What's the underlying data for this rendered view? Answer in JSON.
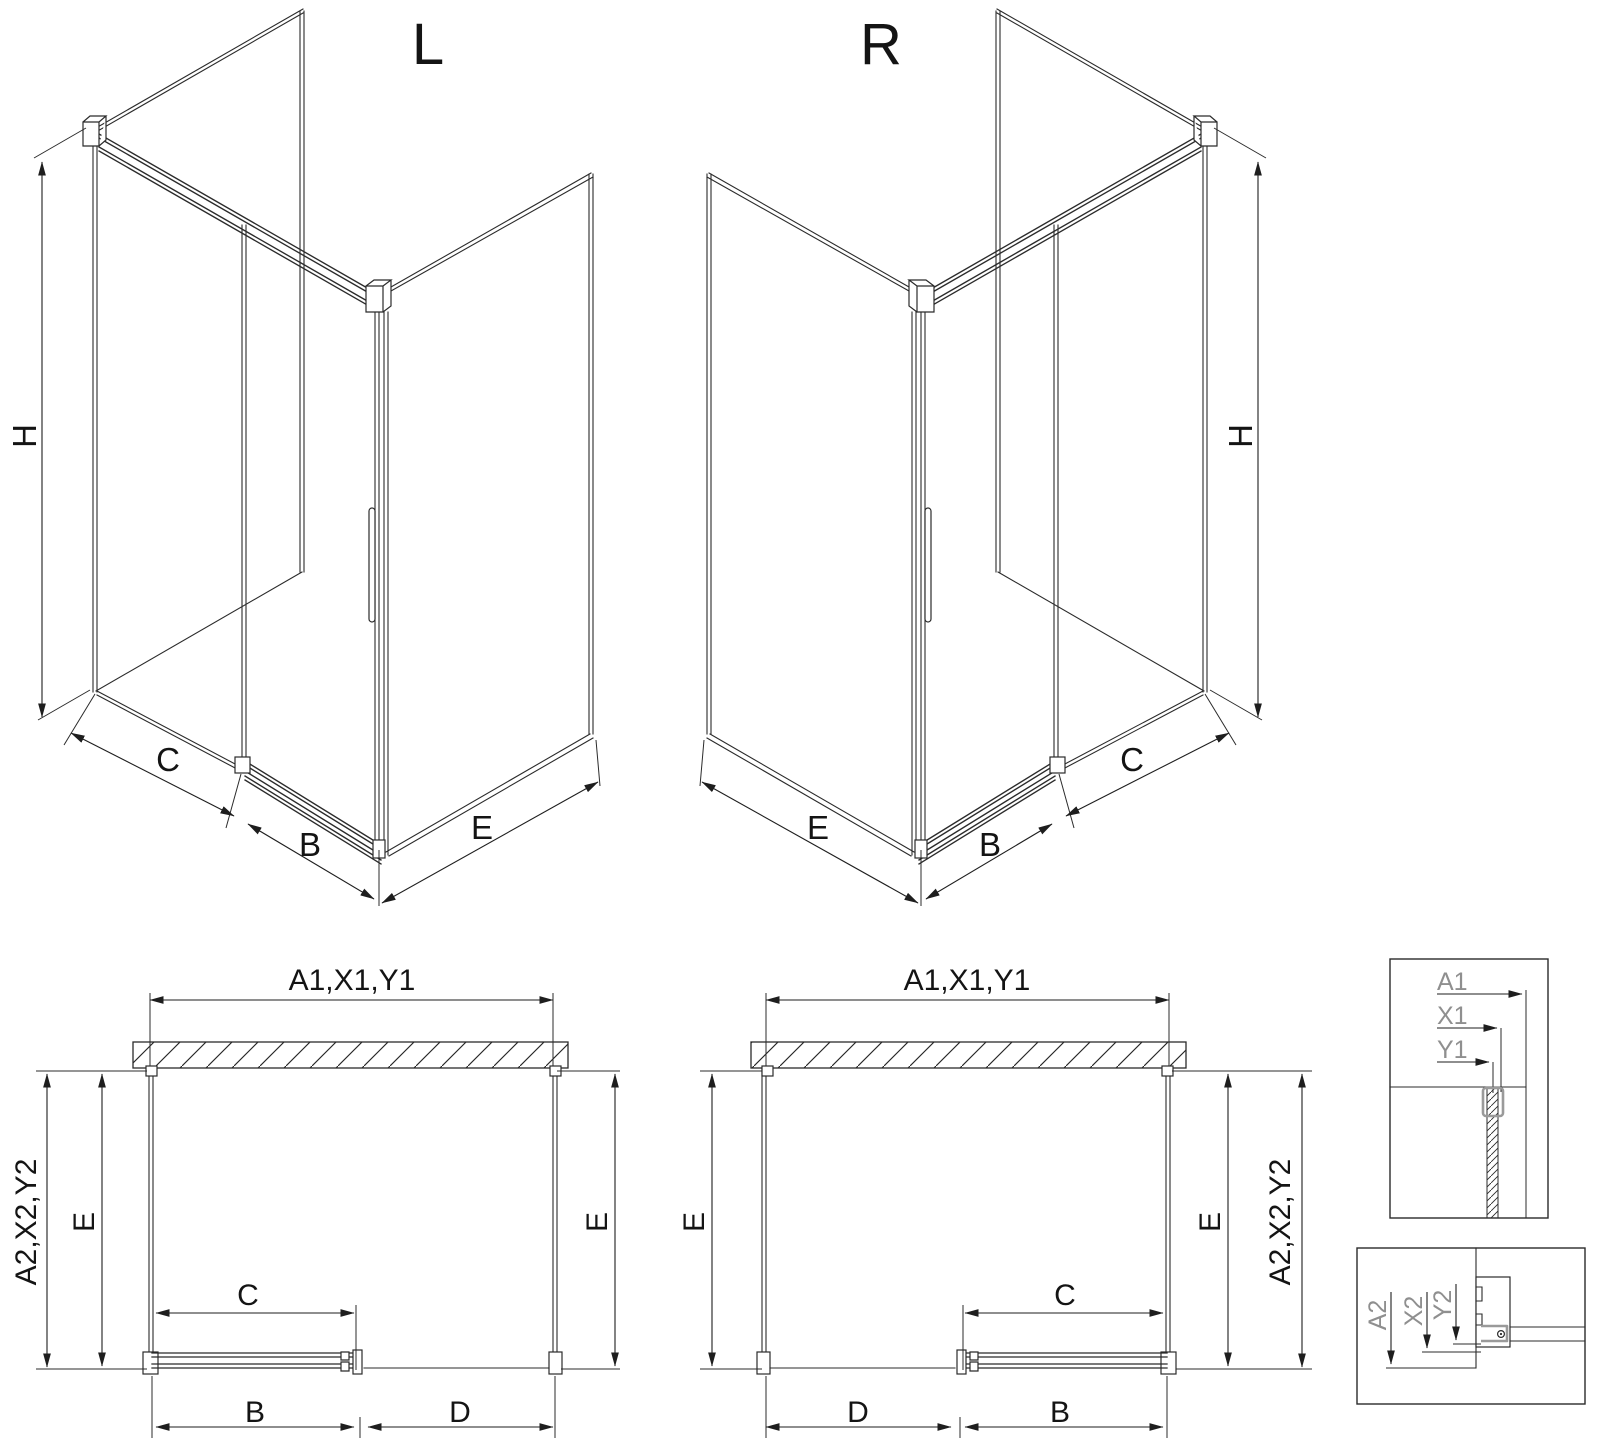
{
  "drawing": {
    "variant_left": {
      "title": "L"
    },
    "variant_right": {
      "title": "R"
    },
    "dim_labels": {
      "height": "H",
      "fixed_segment": "C",
      "door_width": "B",
      "side_panel": "E",
      "front_fixed": "D",
      "width_group_top": "A1,X1,Y1",
      "depth_group_side": "A2,X2,Y2"
    },
    "detail_labels": {
      "a1": "A1",
      "x1": "X1",
      "y1": "Y1",
      "a2": "A2",
      "x2": "X2",
      "y2": "Y2"
    },
    "colors": {
      "line": "#2b2b2b",
      "text": "#141414",
      "detail_text": "#8f8f8f",
      "fitting_gray": "#9a9a9a",
      "background": "#ffffff"
    }
  }
}
